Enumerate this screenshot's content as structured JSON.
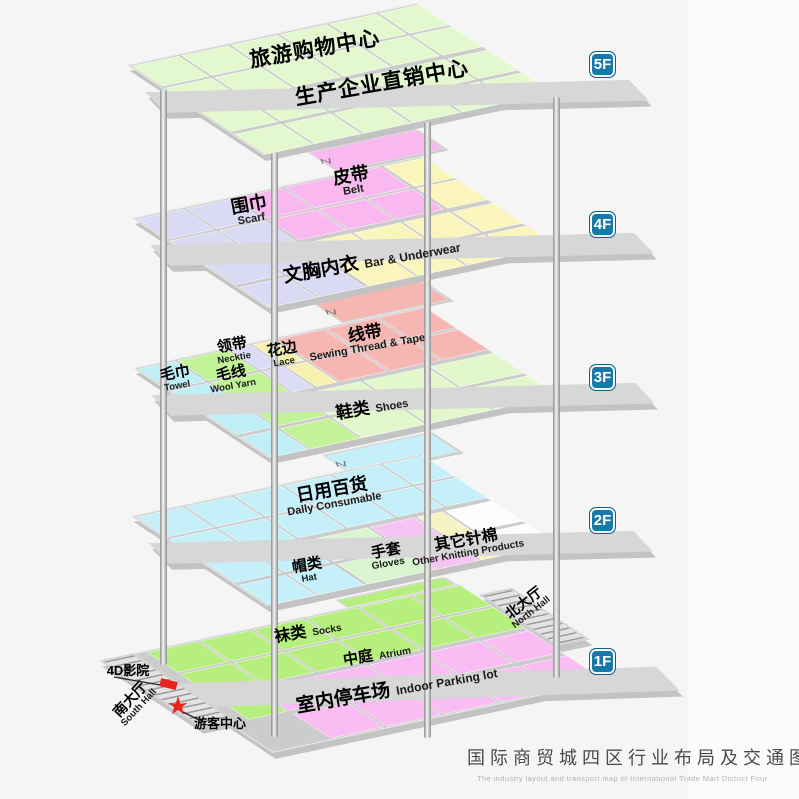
{
  "floors": [
    {
      "badge": "5F",
      "areas": [
        {
          "zh": "旅游购物中心",
          "en": ""
        },
        {
          "zh": "生产企业直销中心",
          "en": ""
        }
      ]
    },
    {
      "badge": "4F",
      "areas": [
        {
          "zh": "围巾",
          "en": "Scarf"
        },
        {
          "zh": "皮带",
          "en": "Belt"
        },
        {
          "zh": "文胸内衣",
          "en": "Bar & Underwear"
        }
      ]
    },
    {
      "badge": "3F",
      "areas": [
        {
          "zh": "毛巾",
          "en": "Towel"
        },
        {
          "zh": "毛线",
          "en": "Wool Yarn"
        },
        {
          "zh": "领带",
          "en": "Necktie"
        },
        {
          "zh": "花边",
          "en": "Lace"
        },
        {
          "zh": "线带",
          "en": "Sewing Thread & Tape"
        },
        {
          "zh": "鞋类",
          "en": "Shoes"
        }
      ]
    },
    {
      "badge": "2F",
      "areas": [
        {
          "zh": "日用百货",
          "en": "Dally Consumable"
        },
        {
          "zh": "帽类",
          "en": "Hat"
        },
        {
          "zh": "手套",
          "en": "Gloves"
        },
        {
          "zh": "其它针棉",
          "en": "Other Knitting Products"
        }
      ]
    },
    {
      "badge": "1F",
      "areas": [
        {
          "zh": "袜类",
          "en": "Socks"
        },
        {
          "zh": "中庭",
          "en": "Atrium"
        },
        {
          "zh": "室内停车场",
          "en": "Indoor Parking lot"
        }
      ],
      "annotations": [
        {
          "zh": "北大厅",
          "en": "North Hall"
        },
        {
          "zh": "南大厅",
          "en": "South Hall"
        },
        {
          "zh": "4D影院"
        },
        {
          "zh": "游客中心"
        }
      ]
    }
  ],
  "caption": {
    "zh": "国际商贸城四区行业布局及交通图",
    "en": "The industry layout and transport map of International Trade Mart District Four"
  },
  "colors": {
    "badge": "#1879a9",
    "red": "#e8241e",
    "walkway": "#d7d7d7",
    "green5f": "#e3f8cf",
    "lavender4f": "#dadaf5",
    "pink4f": "#f9b9f0",
    "yellow4f": "#f9f5bd",
    "cyan3f": "#c0eef7",
    "green3f": "#c3f398",
    "lavender3f": "#dcdcf6",
    "yellow3f": "#f7f1b0",
    "salmon3f": "#f6b7b2",
    "palegreen3f": "#e2f7cc",
    "cyan2f": "#c5f0f9",
    "palegreen2f": "#d9f5cf",
    "pink2f": "#f6c4f3",
    "paleyellow2f": "#f8f3c4",
    "white2f": "#fdfdfd",
    "green1f": "#b7ef7e",
    "pink1f": "#f9bdf3"
  }
}
